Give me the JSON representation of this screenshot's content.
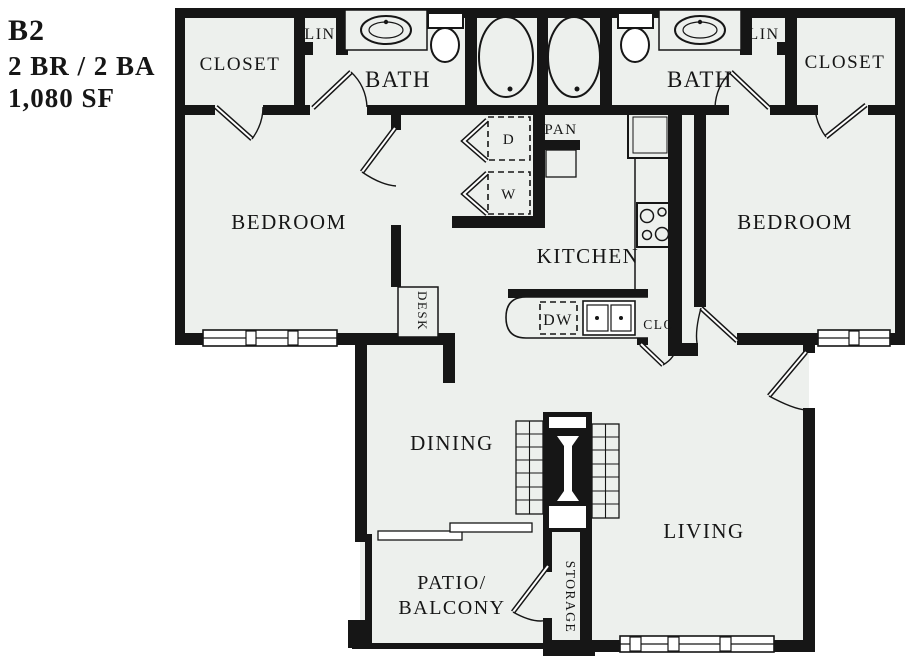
{
  "title": {
    "code": "B2",
    "config": "2 BR / 2 BA",
    "area": "1,080 SF"
  },
  "rooms": {
    "closet_left": "CLOSET",
    "linen_left": "LIN",
    "bath_left": "BATH",
    "bath_right": "BATH",
    "linen_right": "LIN",
    "closet_right": "CLOSET",
    "bedroom_left": "BEDROOM",
    "bedroom_right": "BEDROOM",
    "kitchen": "KITCHEN",
    "dining": "DINING",
    "living": "LIVING",
    "patio_line1": "PATIO/",
    "patio_line2": "BALCONY",
    "storage": "STORAGE",
    "hall_closet": "CLO",
    "pantry": "PAN",
    "desk": "DESK"
  },
  "appliances": {
    "dishwasher": "DW",
    "dryer": "D",
    "washer": "W"
  },
  "colors": {
    "wall": "#161616",
    "floor": "#edf0ed",
    "background": "#ffffff"
  }
}
